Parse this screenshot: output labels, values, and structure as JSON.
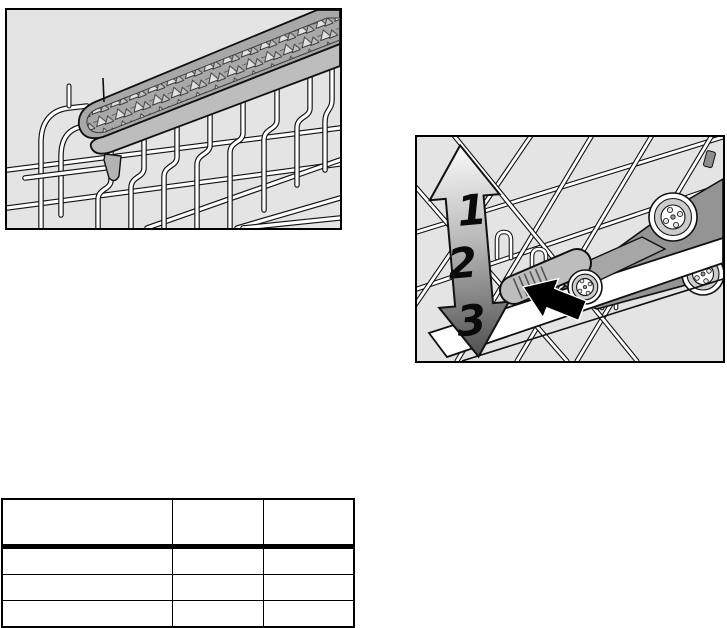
{
  "figures": {
    "cutlery_shelf": {
      "icon": "cutlery-shelf-on-rack-illustration",
      "background": "#e4e4e4",
      "border_color": "#000000"
    },
    "rack_adjustment": {
      "icon": "rack-height-adjustment-illustration",
      "background": "#e4e4e4",
      "border_color": "#000000",
      "level_labels": [
        "1",
        "2",
        "3"
      ]
    }
  },
  "table": {
    "headers": [
      "",
      "",
      ""
    ],
    "rows": [
      [
        "",
        "",
        ""
      ],
      [
        "",
        "",
        ""
      ],
      [
        "",
        "",
        ""
      ]
    ]
  },
  "colors": {
    "page_background": "#ffffff",
    "figure_background": "#e4e4e4",
    "line": "#111111",
    "wire": "#ffffff",
    "tray_gray": "#b0b0b0",
    "panel_gray": "#949494",
    "arrow_black": "#000000",
    "arrow_gradient_top": "#fafafa",
    "arrow_gradient_bottom": "#4f4f4f"
  }
}
